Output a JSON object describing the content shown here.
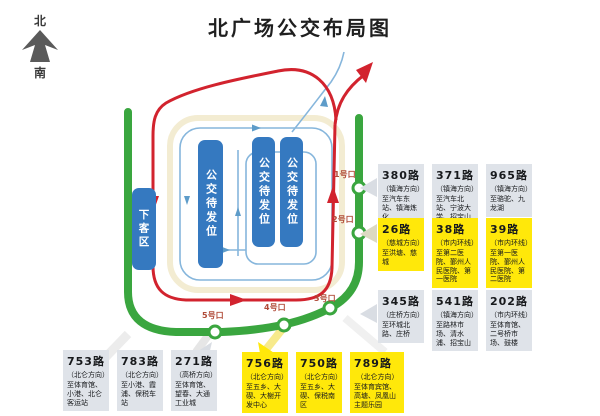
{
  "title": "北广场公交布局图",
  "compass": {
    "north": "北",
    "south": "南"
  },
  "map": {
    "platforms": {
      "drop_off": "下客区",
      "waiting": "公交待发位"
    },
    "exits": [
      "1号口",
      "2号口",
      "3号口",
      "4号口",
      "5号口"
    ]
  },
  "colors": {
    "road_green": "#3aa63f",
    "route_red": "#d2232e",
    "route_blue": "#86b6dc",
    "platform_blue": "#3579c0",
    "box_gray": "#dfe3e9",
    "box_yellow": "#ffe80a",
    "exit_label": "#b04a38"
  },
  "route_groups": [
    {
      "id": "exit-1-routes",
      "style": "gray",
      "routes": [
        {
          "number": "380路",
          "direction": "（镇海方向）",
          "destinations": "至汽车东站、镇海炼化"
        },
        {
          "number": "371路",
          "direction": "（镇海方向）",
          "destinations": "至汽车北站、宁波大学、招宝山"
        },
        {
          "number": "965路",
          "direction": "（镇海方向）",
          "destinations": "至骆驼、九龙湖"
        }
      ]
    },
    {
      "id": "exit-2-routes",
      "style": "yellow",
      "routes": [
        {
          "number": "26路",
          "direction": "（慈城方向）",
          "destinations": "至洪塘、慈城"
        },
        {
          "number": "38路",
          "direction": "（市内环线）",
          "destinations": "至第二医院、鄞州人民医院、第一医院"
        },
        {
          "number": "39路",
          "direction": "（市内环线）",
          "destinations": "至第一医院、鄞州人民医院、第二医院"
        }
      ]
    },
    {
      "id": "exit-3-routes",
      "style": "gray",
      "routes": [
        {
          "number": "345路",
          "direction": "（庄桥方向）",
          "destinations": "至环城北路、庄桥"
        },
        {
          "number": "541路",
          "direction": "（镇海方向）",
          "destinations": "至路林市场、清水浦、招宝山"
        },
        {
          "number": "202路",
          "direction": "（市内环线）",
          "destinations": "至体育馆、二号桥市场、鼓楼"
        }
      ]
    },
    {
      "id": "exit-5-routes",
      "style": "gray",
      "routes": [
        {
          "number": "753路",
          "direction": "（北仑方向）",
          "destinations": "至体育馆、小港、北仑客运站"
        },
        {
          "number": "783路",
          "direction": "（北仑方向）",
          "destinations": "至小港、霞浦、保税车站"
        },
        {
          "number": "271路",
          "direction": "（高桥方向）",
          "destinations": "至体育馆、望春、大通工业城"
        }
      ]
    },
    {
      "id": "exit-4-routes",
      "style": "yellow",
      "routes": [
        {
          "number": "756路",
          "direction": "（北仑方向）",
          "destinations": "至五乡、大碶、大榭开发中心"
        },
        {
          "number": "750路",
          "direction": "（北仑方向）",
          "destinations": "至五乡、大碶、保税南区"
        },
        {
          "number": "789路",
          "direction": "（北仑方向）",
          "destinations": "至体育宾馆、高塘、凤凰山主题乐园"
        }
      ]
    }
  ]
}
